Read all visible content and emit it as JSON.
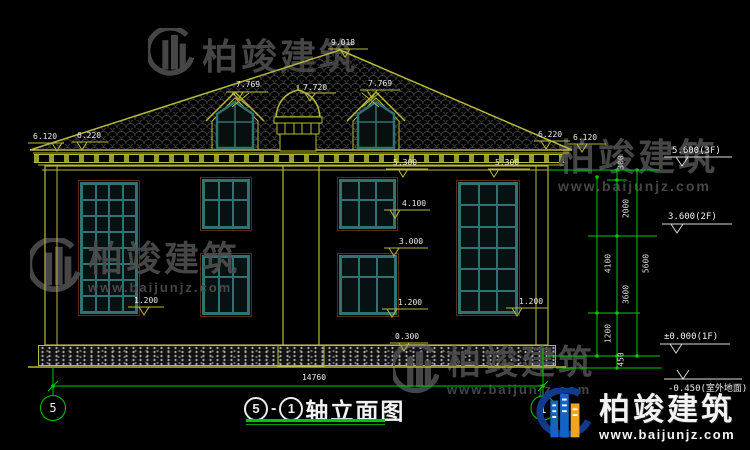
{
  "colors": {
    "line_yellow": "#b8b83a",
    "dim_green": "#00c800",
    "window_teal": "#2f7272",
    "window_surround": "#5a2a12",
    "text_white": "#e9e9e9",
    "watermark_gray": "#4d4d4d",
    "logo_blue": "#1463c6",
    "logo_orange": "#f2a31d",
    "logo_swoosh": "#123a8c"
  },
  "watermark": {
    "brand": "柏竣建筑",
    "site": "www.baijunjz.com"
  },
  "brand_logo": {
    "brand": "柏竣建筑",
    "site": "www.baijunjz.com"
  },
  "title": {
    "axis_left": "5",
    "separator": "-",
    "axis_right": "1",
    "label": "轴立面图"
  },
  "axis_bubbles": {
    "left": "5",
    "right": "1"
  },
  "dims": {
    "peak": "9.018",
    "dormer_left": "7.769",
    "cupola": "7.720",
    "dormer_right": "7.769",
    "eave_left_outer": "6.120",
    "eave_left_inner": "6.220",
    "eave_right_inner": "6.220",
    "eave_right_outer": "6.120",
    "win_top_left": "5.300",
    "win_top_right": "5.300",
    "sill_2f": "4.100",
    "top_1f": "3.000",
    "sill_1f_left": "1.200",
    "sill_1f_center": "1.200",
    "sill_1f_right": "1.200",
    "plinth": "0.300",
    "total_width": "14760"
  },
  "levels": {
    "f3": "5.600(3F)",
    "f2": "3.600(2F)",
    "f1": "±0.000(1F)",
    "ground": "-0.450(室外地面)"
  },
  "vdims": {
    "v300": "300",
    "v2000": "2000",
    "v4100": "4100",
    "v3600": "3600",
    "v1200": "1200",
    "v450": "450",
    "vtotal": "5600"
  }
}
